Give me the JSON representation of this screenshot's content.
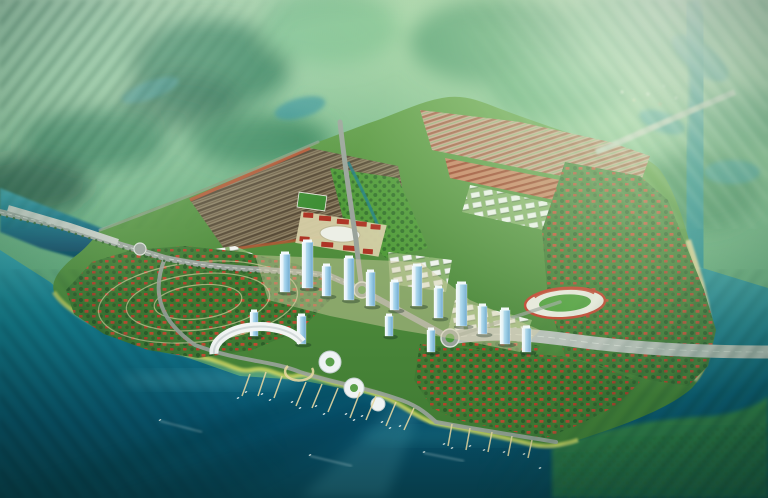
{
  "meta": {
    "description": "Blurred-edge aerial 3D rendering of a planned waterfront city: row-house districts and a central park axis on an island, a high-rise CBD, a marina bay lined with piers and boats, concentric villa rings on a peninsula, a stadium, red-roof villa quarters, and highway bridges crossing surrounding rivers and green marshland."
  },
  "palette": {
    "bg_top": "#a9d6ab",
    "bg_mid": "#64ab7d",
    "bg_low": "#3f8a5f",
    "marsh_dark": "#1d5c40",
    "marsh_mid": "#35815b",
    "marsh_light": "#8fca9c",
    "lake_teal": "#2d8f98",
    "water_top": "#2d9aa5",
    "water_mid": "#13798c",
    "water_deep": "#07506b",
    "water_dark": "#063a4c",
    "water_light": "#7fd4da",
    "land": "#5d9c44",
    "land_dark": "#3f7a33",
    "land_se": "#378746",
    "park": "#4f9a38",
    "tree": "#2c5f28",
    "shore_yellow": "#ccd562",
    "sand": "#e6d7a0",
    "plaza": "#d6cfa6",
    "roof_red": "#bf4b30",
    "roof_dark": "#574a36",
    "row_brown": "#8c7f63",
    "row_pink": "#caa28e",
    "row_pink_stripe": "#a55a44",
    "row_red": "#c87d5e",
    "row_red_stripe": "#9c3e28",
    "white_bldg": "#f1f4f0",
    "apt_ground": "#86b06b",
    "tower_light": "#eaf6fb",
    "tower_mid": "#9fd0ea",
    "tower_dark": "#6fa8cc",
    "road": "#9aa39b",
    "road_big": "#b9c0ba",
    "road_line": "#dadfd8",
    "stand_red": "#c13f2c",
    "campus_red": "#ae3526",
    "canal": "#1f7f8a"
  },
  "scene": {
    "towers": [
      [
        280,
        292,
        10,
        38
      ],
      [
        302,
        288,
        11,
        46
      ],
      [
        322,
        296,
        9,
        30
      ],
      [
        344,
        300,
        10,
        42
      ],
      [
        366,
        306,
        9,
        34
      ],
      [
        390,
        310,
        9,
        28
      ],
      [
        412,
        306,
        10,
        40
      ],
      [
        434,
        318,
        9,
        30
      ],
      [
        456,
        326,
        11,
        42
      ],
      [
        478,
        334,
        9,
        28
      ],
      [
        500,
        344,
        10,
        34
      ],
      [
        250,
        336,
        8,
        24
      ],
      [
        297,
        344,
        9,
        28
      ],
      [
        522,
        352,
        9,
        24
      ],
      [
        427,
        352,
        8,
        22
      ],
      [
        385,
        336,
        8,
        20
      ]
    ],
    "piers": [
      [
        250,
        374,
        242,
        396
      ],
      [
        266,
        372,
        258,
        396
      ],
      [
        282,
        376,
        274,
        398
      ],
      [
        306,
        382,
        296,
        406
      ],
      [
        322,
        384,
        312,
        408
      ],
      [
        338,
        388,
        328,
        412
      ],
      [
        360,
        392,
        350,
        418
      ],
      [
        376,
        396,
        366,
        420
      ],
      [
        396,
        402,
        386,
        426
      ],
      [
        414,
        408,
        404,
        430
      ],
      [
        452,
        424,
        448,
        446
      ],
      [
        470,
        428,
        466,
        450
      ],
      [
        492,
        432,
        488,
        452
      ],
      [
        512,
        436,
        508,
        456
      ],
      [
        532,
        440,
        528,
        458
      ]
    ],
    "boats": [
      [
        238,
        398,
        -25
      ],
      [
        246,
        392,
        -25
      ],
      [
        262,
        394,
        -25
      ],
      [
        270,
        400,
        -25
      ],
      [
        292,
        402,
        -25
      ],
      [
        300,
        408,
        -25
      ],
      [
        316,
        406,
        -25
      ],
      [
        324,
        414,
        -25
      ],
      [
        346,
        414,
        -25
      ],
      [
        354,
        420,
        -25
      ],
      [
        362,
        416,
        -25
      ],
      [
        382,
        422,
        -25
      ],
      [
        390,
        428,
        -25
      ],
      [
        400,
        426,
        -25
      ],
      [
        444,
        444,
        -20
      ],
      [
        452,
        448,
        -20
      ],
      [
        470,
        446,
        -20
      ],
      [
        484,
        450,
        -20
      ],
      [
        504,
        452,
        -20
      ],
      [
        524,
        454,
        -20
      ],
      [
        160,
        420,
        -30
      ],
      [
        310,
        455,
        -20
      ],
      [
        424,
        452,
        -15
      ],
      [
        540,
        468,
        -18
      ]
    ],
    "wakes": [
      [
        160,
        421,
        202,
        432
      ],
      [
        310,
        456,
        352,
        466
      ],
      [
        424,
        453,
        464,
        461
      ]
    ]
  }
}
